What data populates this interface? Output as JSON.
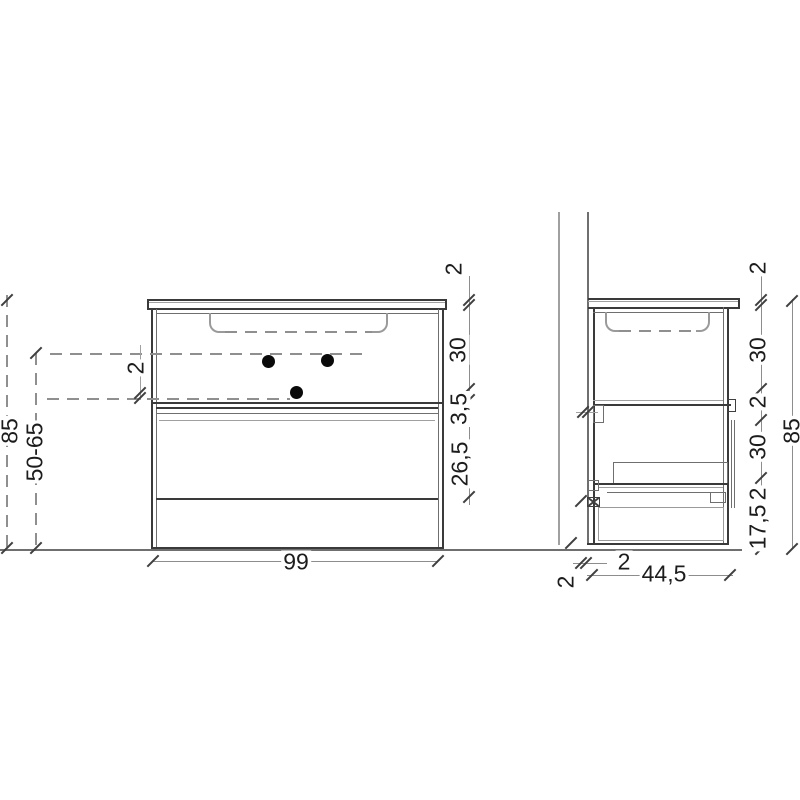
{
  "front_view": {
    "width_label": "99",
    "left": {
      "total_height": "85",
      "mount_range": "50-65",
      "offset": "2"
    },
    "right": {
      "countertop": "2",
      "upper_section": "30",
      "shelf": "3,5",
      "drawer_front": "26,5"
    }
  },
  "side_view": {
    "depth_label": "44,5",
    "bottom": {
      "back_offset": "2",
      "wall_gap": "2"
    },
    "right": {
      "countertop": "2",
      "upper_section": "30",
      "shelf": "2",
      "mid_section": "30",
      "small": "2",
      "bottom_section": "17,5",
      "total_height": "85"
    }
  }
}
